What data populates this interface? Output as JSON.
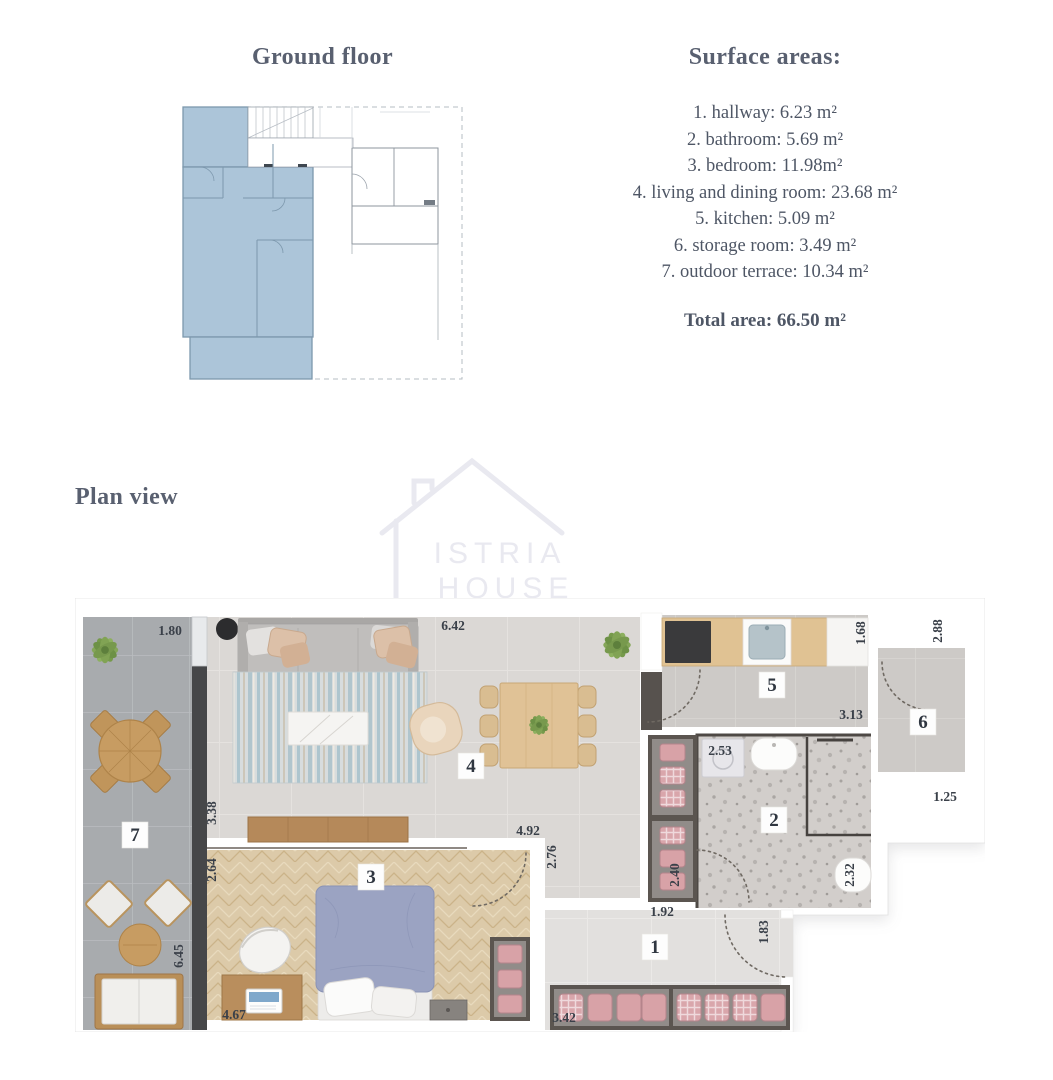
{
  "palette": {
    "heading_color": "#596070",
    "body_text_color": "#4e5665",
    "unit_highlight_blue": "#acc5d9",
    "closet_pink": "#d8a2a7",
    "bed_blue": "#9ba3c2",
    "wood_tone": "#c79c62",
    "dark_wall": "#464749"
  },
  "ground_floor": {
    "title": "Ground floor"
  },
  "surface_areas": {
    "title": "Surface areas:",
    "items": [
      "1. hallway: 6.23 m²",
      "2. bathroom: 5.69 m²",
      "3. bedroom: 11.98m²",
      "4. living and dining room: 23.68 m²",
      "5. kitchen: 5.09 m²",
      "6. storage room: 3.49 m²",
      "7. outdoor terrace: 10.34 m²"
    ],
    "total": "Total area: 66.50 m²"
  },
  "plan_view": {
    "title": "Plan view",
    "watermark": {
      "line1": "ISTRIA",
      "line2": "HOUSE"
    },
    "room_numbers": {
      "hallway": "1",
      "bathroom": "2",
      "bedroom": "3",
      "living": "4",
      "kitchen": "5",
      "storage": "6",
      "terrace": "7"
    },
    "dimensions": {
      "terrace_width": "1.80",
      "living_width": "6.42",
      "kitchen_depth": "1.68",
      "storage_height": "2.88",
      "kitchen_width": "3.13",
      "living_depth": "3.38",
      "bedroom_offset": "2.64",
      "living_lower_width": "4.92",
      "living_lower_depth": "2.76",
      "bathroom_width": "2.53",
      "closet_height": "2.40",
      "hallway_width": "1.92",
      "bathroom_depth": "2.32",
      "storage_width": "1.25",
      "terrace_height": "6.45",
      "bedroom_width": "4.67",
      "wardrobe_width": "3.42",
      "entry_depth": "1.83"
    }
  }
}
